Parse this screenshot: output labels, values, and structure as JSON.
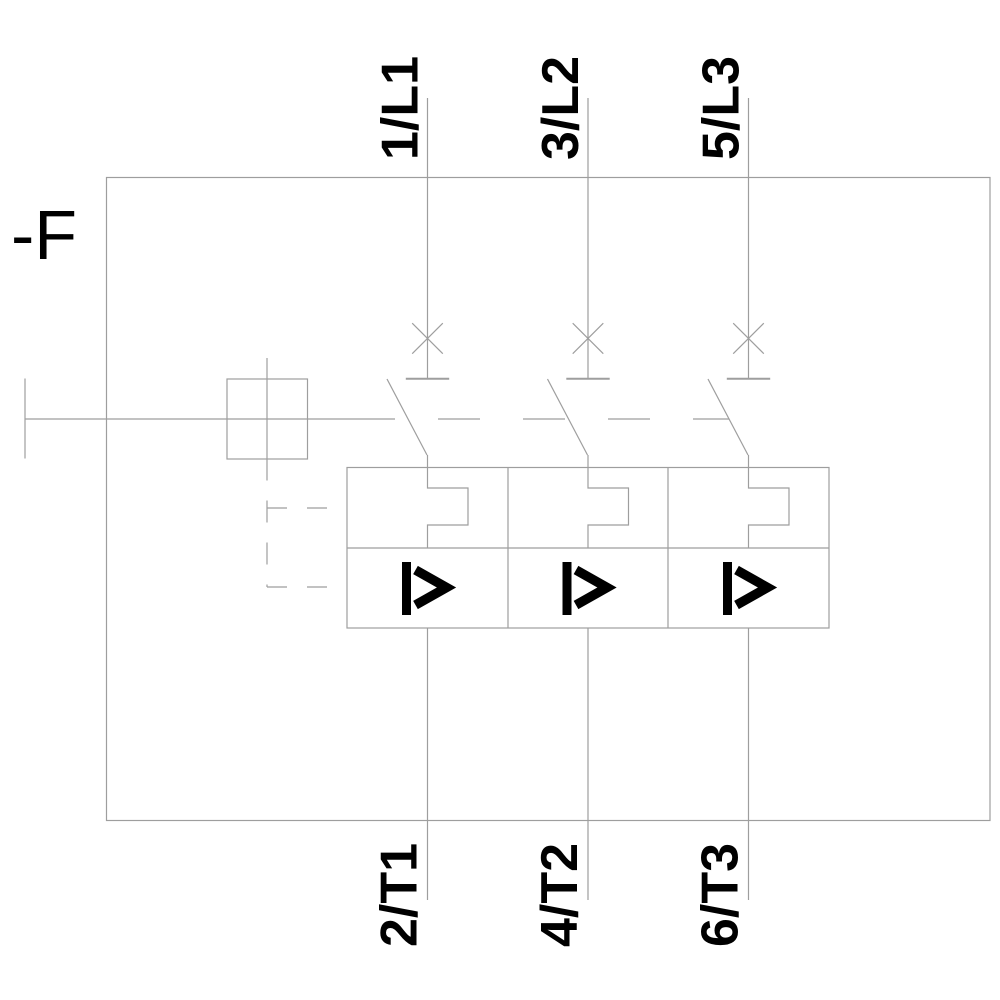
{
  "colors": {
    "background": "#ffffff",
    "line": "#9e9e9e",
    "text": "#000000"
  },
  "device": {
    "designation": "-F"
  },
  "terminals": {
    "top": [
      {
        "label": "1/L1"
      },
      {
        "label": "3/L2"
      },
      {
        "label": "5/L3"
      }
    ],
    "bottom": [
      {
        "label": "2/T1"
      },
      {
        "label": "4/T2"
      },
      {
        "label": "6/T3"
      }
    ]
  },
  "symbols": {
    "contact": "x-cross",
    "thermal_overload_release": "rectangular-bend",
    "instantaneous_overcurrent_release": "I>",
    "actuator": "square-knob-with-handle",
    "mechanical_linkage": "dashed-lines"
  }
}
